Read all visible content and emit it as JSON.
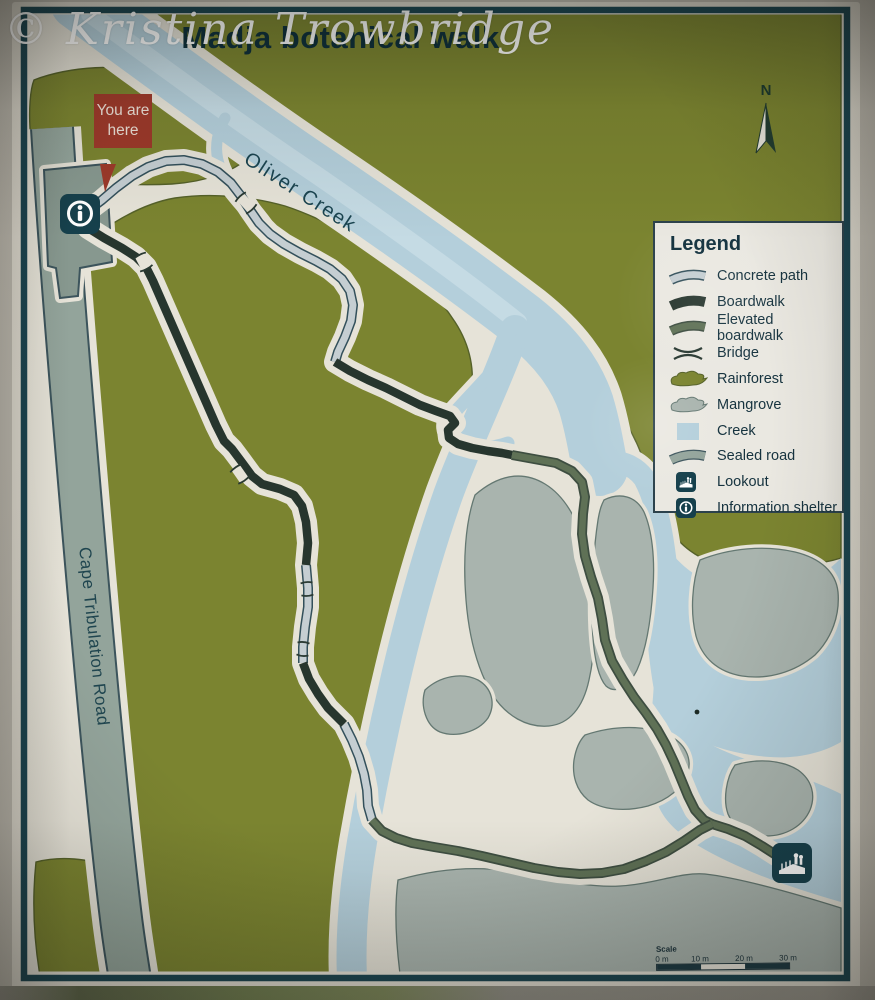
{
  "photo": {
    "watermark": "© Kristina Trowbridge"
  },
  "sign": {
    "title": "Madja botanical walk",
    "you_are_here": "You are here",
    "labels": {
      "creek": "Oliver Creek",
      "road": "Cape Tribulation Road",
      "north": "N"
    },
    "legend": {
      "title": "Legend",
      "items": [
        {
          "label": "Concrete path",
          "symbol": "concrete-path"
        },
        {
          "label": "Boardwalk",
          "symbol": "boardwalk"
        },
        {
          "label": "Elevated boardwalk",
          "symbol": "elevated-boardwalk"
        },
        {
          "label": "Bridge",
          "symbol": "bridge"
        },
        {
          "label": "Rainforest",
          "symbol": "rainforest"
        },
        {
          "label": "Mangrove",
          "symbol": "mangrove"
        },
        {
          "label": "Creek",
          "symbol": "creek"
        },
        {
          "label": "Sealed road",
          "symbol": "sealed-road"
        },
        {
          "label": "Lookout",
          "symbol": "lookout"
        },
        {
          "label": "Information shelter",
          "symbol": "information-shelter"
        }
      ]
    },
    "scale": {
      "label": "Scale",
      "ticks": [
        "0 m",
        "10 m",
        "20 m",
        "30 m"
      ]
    },
    "colors": {
      "rainforest": "#7b8430",
      "rainforest_edge": "#556129",
      "mangrove": "#a9b4ae",
      "mangrove_edge": "#647872",
      "creek": "#b4cfdb",
      "sand": "#e6e3d8",
      "sealed_road": "#93a49b",
      "road_edge": "#3c545c",
      "boardwalk": "#27362e",
      "elevated_boardwalk": "#5f7156",
      "concrete_path": "#c5ced2",
      "trail_outline": "#33505b",
      "you_are_here_red": "#9c392a",
      "sign_border": "#1a4450",
      "icon_square": "#16404c",
      "text_dark": "#12323d"
    }
  }
}
